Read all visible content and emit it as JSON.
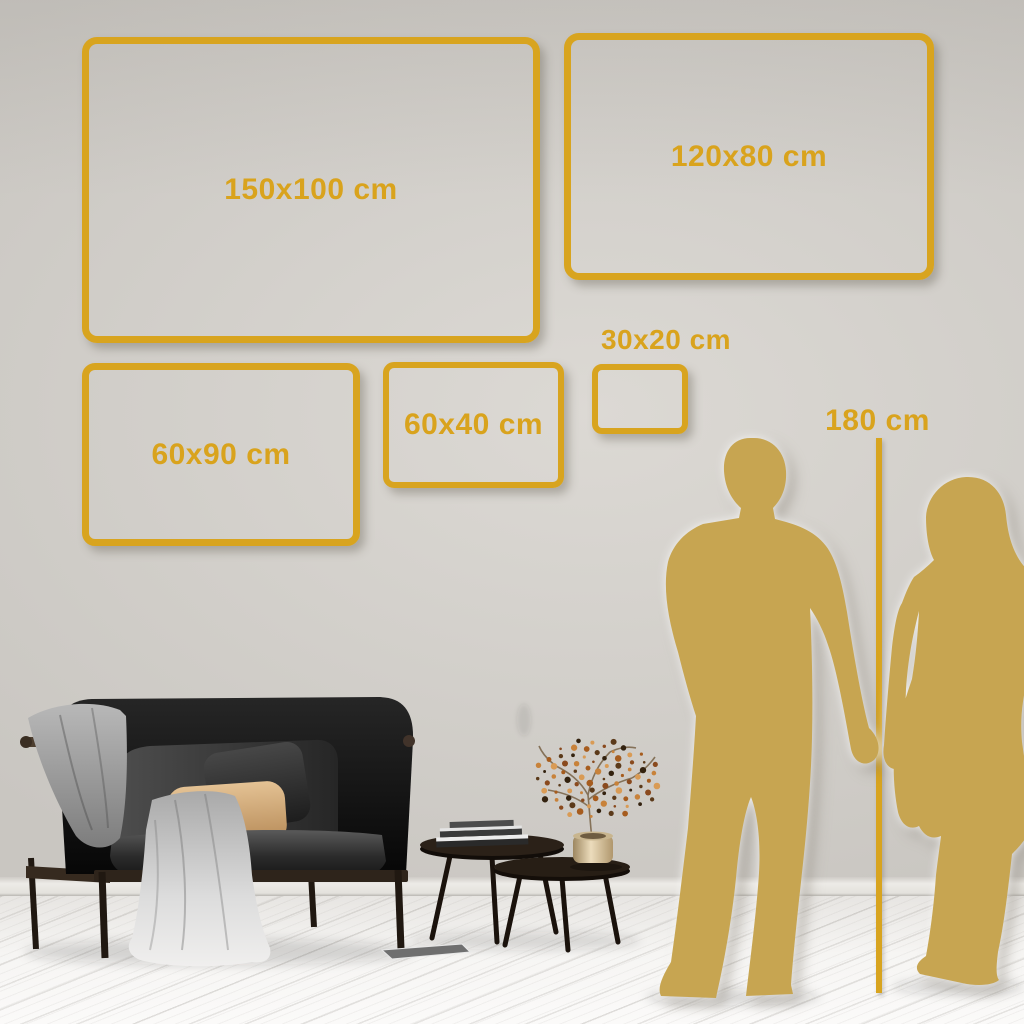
{
  "size_guide": {
    "frames": [
      {
        "id": "150x100",
        "label": "150x100 cm"
      },
      {
        "id": "120x80",
        "label": "120x80 cm"
      },
      {
        "id": "60x90",
        "label": "60x90 cm"
      },
      {
        "id": "60x40",
        "label": "60x40 cm"
      },
      {
        "id": "30x20",
        "label": "30x20 cm"
      }
    ],
    "height_reference": {
      "label": "180 cm"
    }
  },
  "colors": {
    "accent_gold": "#d8a41f",
    "label_gold": "#d9a31d",
    "silhouette_gold": "#c7a551",
    "wall_light": "#dcd9d4",
    "wall_dark": "#c9c6c1",
    "floor_light": "#f6f5f3"
  }
}
